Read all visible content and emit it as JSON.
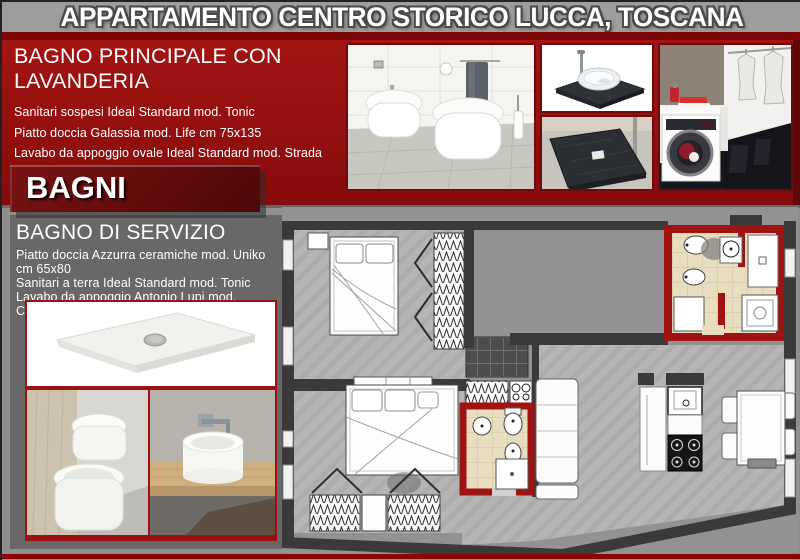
{
  "title": "APPARTAMENTO CENTRO STORICO LUCCA, TOSCANA",
  "badge": {
    "label": "BAGNI"
  },
  "main_bath": {
    "heading": "BAGNO PRINCIPALE CON LAVANDERIA",
    "items": [
      "Sanitari sospesi Ideal Standard mod. Tonic",
      "Piatto doccia Galassia mod. Life cm 75x135",
      "Lavabo da appoggio ovale Ideal Standard mod. Strada",
      "Lavasciuga AEG L 99695 HWD"
    ]
  },
  "service_bath": {
    "heading": "BAGNO DI SERVIZIO",
    "items": [
      "Piatto doccia Azzurra ceramiche mod. Uniko cm 65x80",
      "Sanitari a terra Ideal Standard mod. Tonic",
      "Lavabo da appoggio Antonio Lupi mod. Cerchio"
    ]
  },
  "photos": {
    "top": [
      "wall-hung-toilets-photo",
      "countertop-basin-photo",
      "dark-shower-tray-photo",
      "laundry-washer-photo"
    ],
    "left": [
      "white-shower-tray-photo",
      "floor-toilets-photo",
      "round-basin-photo"
    ]
  },
  "floor_plan": {
    "name": "apartment-floor-plan",
    "highlight_rooms": 2
  },
  "colors": {
    "band_red": "#9a1212",
    "dark_red": "#5c0a0a",
    "accent_red": "#a01313",
    "titlebar_gray": "#9d9d9d",
    "background_gray": "#8f8f8f",
    "panel_gray": "#686868"
  }
}
